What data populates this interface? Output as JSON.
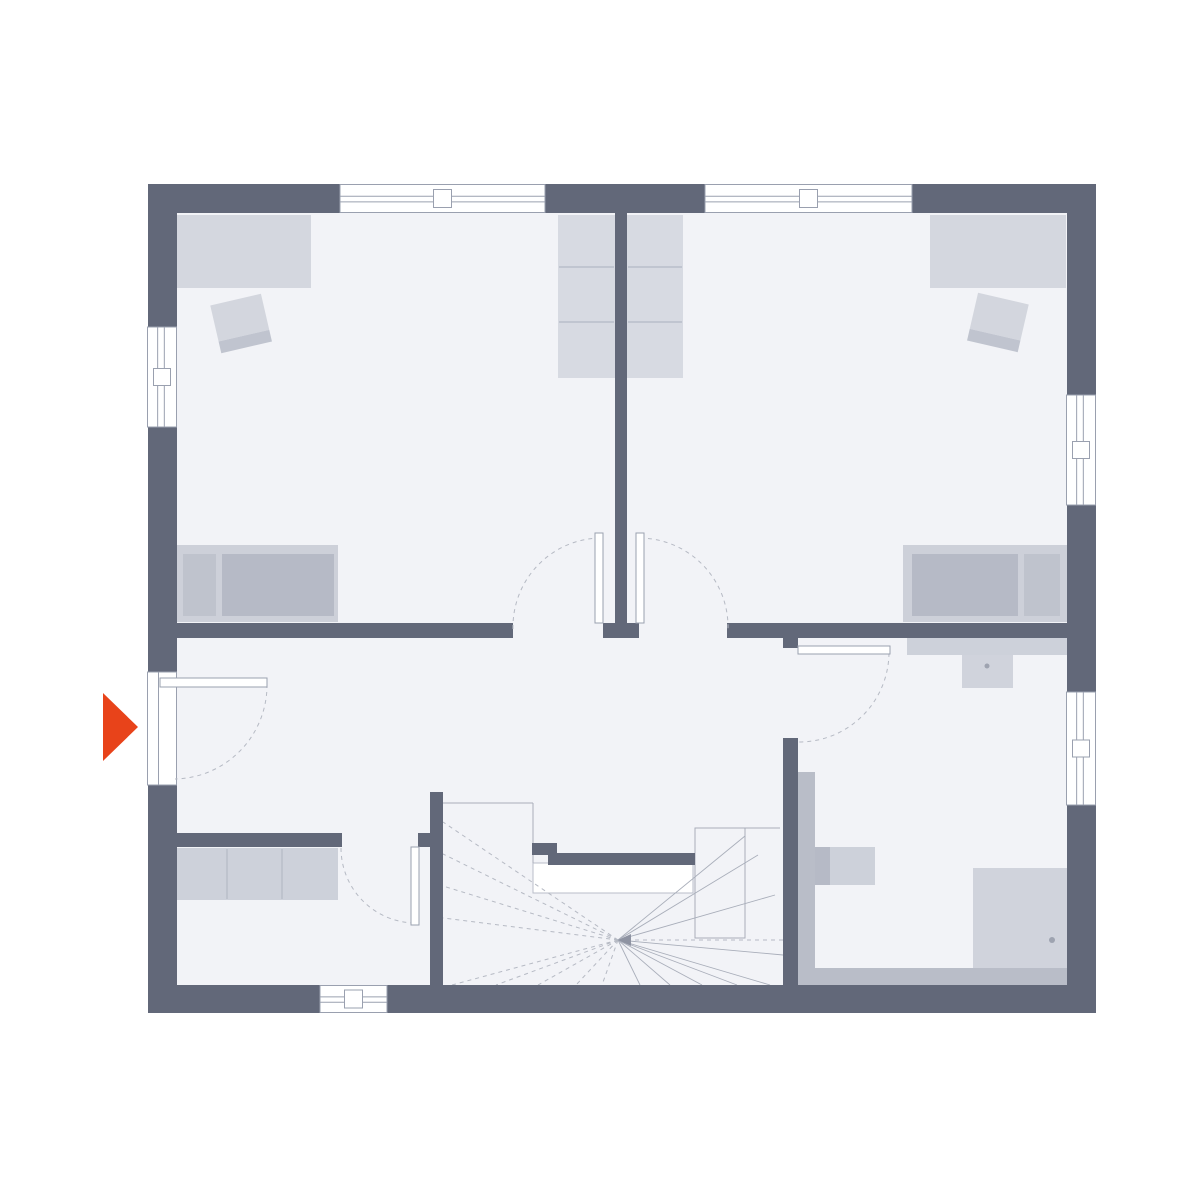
{
  "app": {
    "name": "house-floor-plan-upper-floor",
    "visible_text": ""
  },
  "canvas": {
    "width": 1200,
    "height": 1200,
    "background": "#ffffff"
  },
  "palette": {
    "wall": "#626879",
    "floor": "#f2f3f7",
    "band": "#b9bdc8",
    "wardrobe": "#d4d7df",
    "closet": "#d7dae2",
    "bed_frame": "#cdd0d9",
    "mattress": "#b6bac6",
    "pillow": "#bfc3cd",
    "fixture": "#cdd1da",
    "shower": "#d0d3dc",
    "chair": "#d3d6de",
    "chair_strip": "#c0c4cf",
    "thin_line": "#a9aeba",
    "divider_line": "#b9bec9",
    "window_stroke": "#9aa0af",
    "dash": "#b6bac4",
    "arrow": "#e8431a",
    "void": "#ffffff"
  },
  "floor": {
    "name": "floor-area",
    "x": 177,
    "y": 213,
    "w": 890,
    "h": 772
  },
  "walls": [
    {
      "name": "wall-top-left",
      "x": 148,
      "y": 184,
      "w": 192,
      "h": 29
    },
    {
      "name": "wall-top-center",
      "x": 545,
      "y": 184,
      "w": 160,
      "h": 29
    },
    {
      "name": "wall-top-right",
      "x": 912,
      "y": 184,
      "w": 184,
      "h": 29
    },
    {
      "name": "wall-left-upper",
      "x": 148,
      "y": 184,
      "w": 29,
      "h": 143
    },
    {
      "name": "wall-left-middle",
      "x": 148,
      "y": 427,
      "w": 29,
      "h": 245
    },
    {
      "name": "wall-left-lower",
      "x": 148,
      "y": 785,
      "w": 29,
      "h": 228
    },
    {
      "name": "wall-right-upper",
      "x": 1067,
      "y": 184,
      "w": 29,
      "h": 211
    },
    {
      "name": "wall-right-middle",
      "x": 1067,
      "y": 505,
      "w": 29,
      "h": 187
    },
    {
      "name": "wall-right-lower",
      "x": 1067,
      "y": 805,
      "w": 29,
      "h": 208
    },
    {
      "name": "wall-bottom-left",
      "x": 148,
      "y": 985,
      "w": 172,
      "h": 28
    },
    {
      "name": "wall-bottom-right",
      "x": 387,
      "y": 985,
      "w": 709,
      "h": 28
    },
    {
      "name": "wall-bedroom-divider",
      "x": 615,
      "y": 213,
      "w": 12,
      "h": 410
    },
    {
      "name": "wall-divider-stub",
      "x": 603,
      "y": 623,
      "w": 36,
      "h": 15
    },
    {
      "name": "wall-hallway-left",
      "x": 167,
      "y": 623,
      "w": 346,
      "h": 15
    },
    {
      "name": "wall-hallway-right",
      "x": 727,
      "y": 623,
      "w": 340,
      "h": 15
    },
    {
      "name": "wall-bathroom-stub",
      "x": 783,
      "y": 638,
      "w": 15,
      "h": 10
    },
    {
      "name": "wall-bathroom-left",
      "x": 783,
      "y": 738,
      "w": 15,
      "h": 247
    },
    {
      "name": "wall-niche",
      "x": 167,
      "y": 833,
      "w": 175,
      "h": 14
    },
    {
      "name": "wall-niche-stub",
      "x": 418,
      "y": 833,
      "w": 25,
      "h": 14
    },
    {
      "name": "wall-stair-west",
      "x": 430,
      "y": 792,
      "w": 13,
      "h": 193
    },
    {
      "name": "wall-stair-newel",
      "x": 532,
      "y": 843,
      "w": 25,
      "h": 12
    },
    {
      "name": "wall-stair-landing",
      "x": 548,
      "y": 853,
      "w": 147,
      "h": 12
    }
  ],
  "bands": [
    {
      "name": "bath-install-wall-left",
      "x": 798,
      "y": 772,
      "w": 17,
      "h": 198
    },
    {
      "name": "bath-install-wall-bottom",
      "x": 798,
      "y": 968,
      "w": 269,
      "h": 17
    }
  ],
  "furniture": [
    {
      "name": "wardrobe-bedroom-left",
      "x": 175,
      "y": 215,
      "w": 136,
      "h": 73,
      "fill": "wardrobe"
    },
    {
      "name": "wardrobe-bedroom-right",
      "x": 930,
      "y": 215,
      "w": 136,
      "h": 73,
      "fill": "wardrobe"
    },
    {
      "name": "closet-center-left",
      "x": 558,
      "y": 215,
      "w": 57,
      "h": 163,
      "fill": "closet"
    },
    {
      "name": "closet-center-right",
      "x": 627,
      "y": 215,
      "w": 56,
      "h": 163,
      "fill": "closet"
    },
    {
      "name": "bed-left-frame",
      "x": 177,
      "y": 545,
      "w": 161,
      "h": 77,
      "fill": "bed_frame"
    },
    {
      "name": "bed-left-pillow",
      "x": 183,
      "y": 554,
      "w": 33,
      "h": 62,
      "fill": "pillow"
    },
    {
      "name": "bed-left-mattress",
      "x": 222,
      "y": 554,
      "w": 112,
      "h": 62,
      "fill": "mattress"
    },
    {
      "name": "bed-right-frame",
      "x": 903,
      "y": 545,
      "w": 164,
      "h": 77,
      "fill": "bed_frame"
    },
    {
      "name": "bed-right-mattress",
      "x": 912,
      "y": 554,
      "w": 106,
      "h": 62,
      "fill": "mattress"
    },
    {
      "name": "bed-right-pillow",
      "x": 1024,
      "y": 554,
      "w": 36,
      "h": 62,
      "fill": "pillow"
    },
    {
      "name": "chair-left-seat",
      "x": 215,
      "y": 299,
      "w": 52,
      "h": 37,
      "fill": "chair",
      "rotate": [
        -13,
        241,
        323
      ]
    },
    {
      "name": "chair-left-back",
      "x": 215,
      "y": 336,
      "w": 52,
      "h": 12,
      "fill": "chair_strip",
      "rotate": [
        -13,
        241,
        323
      ]
    },
    {
      "name": "chair-right-seat",
      "x": 972,
      "y": 298,
      "w": 52,
      "h": 37,
      "fill": "chair",
      "rotate": [
        13,
        998,
        322
      ]
    },
    {
      "name": "chair-right-back",
      "x": 972,
      "y": 335,
      "w": 52,
      "h": 12,
      "fill": "chair_strip",
      "rotate": [
        13,
        998,
        322
      ]
    },
    {
      "name": "sideboard-niche",
      "x": 175,
      "y": 848,
      "w": 163,
      "h": 52,
      "fill": "fixture"
    },
    {
      "name": "bath-vanity-counter",
      "x": 907,
      "y": 638,
      "w": 160,
      "h": 17,
      "fill": "fixture"
    },
    {
      "name": "bath-sink",
      "x": 962,
      "y": 655,
      "w": 51,
      "h": 33,
      "fill": "shower"
    },
    {
      "name": "toilet-tank",
      "x": 815,
      "y": 847,
      "w": 15,
      "h": 38,
      "fill": "mattress"
    },
    {
      "name": "toilet-bowl",
      "x": 830,
      "y": 847,
      "w": 45,
      "h": 38,
      "fill": "fixture"
    },
    {
      "name": "shower-tray",
      "x": 973,
      "y": 868,
      "w": 94,
      "h": 100,
      "fill": "shower"
    }
  ],
  "divider_lines": [
    {
      "name": "closet-left-shelf-1",
      "x1": 559,
      "y1": 267,
      "x2": 614,
      "y2": 267
    },
    {
      "name": "closet-left-shelf-2",
      "x1": 559,
      "y1": 322,
      "x2": 614,
      "y2": 322
    },
    {
      "name": "closet-right-shelf-1",
      "x1": 628,
      "y1": 267,
      "x2": 682,
      "y2": 267
    },
    {
      "name": "closet-right-shelf-2",
      "x1": 628,
      "y1": 322,
      "x2": 682,
      "y2": 322
    },
    {
      "name": "sideboard-divider-1",
      "x1": 227,
      "y1": 849,
      "x2": 227,
      "y2": 899
    },
    {
      "name": "sideboard-divider-2",
      "x1": 282,
      "y1": 849,
      "x2": 282,
      "y2": 899
    }
  ],
  "dots": [
    {
      "name": "sink-drain-dot",
      "cx": 987,
      "cy": 666,
      "r": 2.5
    },
    {
      "name": "shower-drain-dot",
      "cx": 1052,
      "cy": 940,
      "r": 3
    }
  ],
  "stair": {
    "name": "winder-staircase",
    "center": [
      618,
      940
    ],
    "void": {
      "name": "stairwell-void",
      "x": 533,
      "y": 863,
      "w": 160,
      "h": 30
    },
    "outline": {
      "name": "stair-tread-box",
      "x": 695,
      "y": 828,
      "w": 50,
      "h": 110
    },
    "thin_lines": [
      {
        "x1": 443,
        "y1": 803,
        "x2": 533,
        "y2": 803
      },
      {
        "x1": 533,
        "y1": 803,
        "x2": 533,
        "y2": 863
      },
      {
        "x1": 695,
        "y1": 828,
        "x2": 780,
        "y2": 828
      }
    ],
    "dashed_rays": [
      [
        443,
        822
      ],
      [
        443,
        854
      ],
      [
        443,
        886
      ],
      [
        443,
        918
      ],
      [
        452,
        985
      ],
      [
        496,
        985
      ],
      [
        538,
        985
      ],
      [
        576,
        985
      ],
      [
        602,
        985
      ]
    ],
    "solid_rays": [
      [
        640,
        985
      ],
      [
        670,
        985
      ],
      [
        702,
        985
      ],
      [
        737,
        985
      ],
      [
        770,
        985
      ],
      [
        783,
        955
      ],
      [
        775,
        895
      ],
      [
        758,
        855
      ],
      [
        745,
        836
      ]
    ],
    "walk_line": {
      "x1": 783,
      "y1": 940,
      "x2": 630,
      "y2": 940
    },
    "walk_arrow": "618,940 631,934 631,946"
  },
  "windows": [
    {
      "name": "window-top-left",
      "x": 340,
      "y": 184.5,
      "w": 205,
      "h": 28,
      "orient": "h"
    },
    {
      "name": "window-top-right",
      "x": 705,
      "y": 184.5,
      "w": 207,
      "h": 28,
      "orient": "h"
    },
    {
      "name": "window-left",
      "x": 147.5,
      "y": 327,
      "w": 29,
      "h": 100,
      "orient": "v"
    },
    {
      "name": "window-right-upper",
      "x": 1066.5,
      "y": 395,
      "w": 29,
      "h": 110,
      "orient": "v"
    },
    {
      "name": "window-right-lower",
      "x": 1066.5,
      "y": 692,
      "w": 29,
      "h": 113,
      "orient": "v"
    },
    {
      "name": "window-bottom",
      "x": 320,
      "y": 985.5,
      "w": 67,
      "h": 27,
      "orient": "h"
    },
    {
      "name": "entrance-door-frame",
      "x": 147.5,
      "y": 672,
      "w": 29,
      "h": 113,
      "orient": "v",
      "door": true
    }
  ],
  "doors": [
    {
      "name": "entrance-door",
      "leaf": {
        "x": 160,
        "y": 678,
        "w": 107,
        "h": 9
      },
      "arc": {
        "start": [
          267,
          684
        ],
        "end": [
          175,
          779
        ],
        "r": 94,
        "sweep": 1
      }
    },
    {
      "name": "door-bedroom-left",
      "leaf": {
        "x": 595,
        "y": 533,
        "w": 8,
        "h": 90
      },
      "arc": {
        "start": [
          513,
          629
        ],
        "end": [
          599,
          538
        ],
        "r": 89,
        "sweep": 1
      }
    },
    {
      "name": "door-bedroom-right",
      "leaf": {
        "x": 636,
        "y": 533,
        "w": 8,
        "h": 90
      },
      "arc": {
        "start": [
          640,
          538
        ],
        "end": [
          728,
          629
        ],
        "r": 89,
        "sweep": 1
      }
    },
    {
      "name": "door-bathroom",
      "leaf": {
        "x": 798,
        "y": 646,
        "w": 92,
        "h": 8
      },
      "arc": {
        "start": [
          889,
          653
        ],
        "end": [
          799,
          742
        ],
        "r": 90,
        "sweep": 1
      }
    },
    {
      "name": "door-niche",
      "leaf": {
        "x": 411,
        "y": 847,
        "w": 8,
        "h": 78
      },
      "arc": {
        "start": [
          341,
          848
        ],
        "end": [
          415,
          923
        ],
        "r": 75,
        "sweep": 0
      }
    }
  ],
  "entrance_arrow": {
    "name": "entrance-direction-arrow",
    "points": "103,693 138,727 103,761"
  }
}
